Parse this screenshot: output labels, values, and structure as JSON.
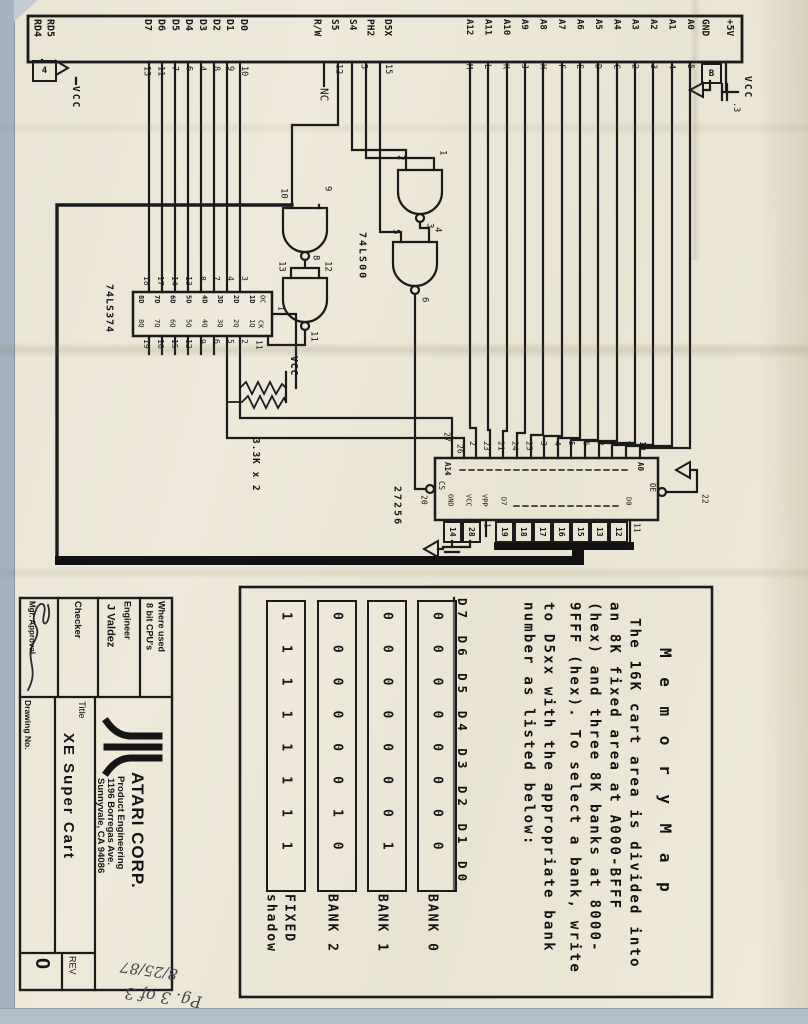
{
  "connector": {
    "left_labels": [
      "RD4",
      "RD5"
    ],
    "left_pin": "4",
    "left_vcc": "VCC",
    "data_labels": [
      "D7",
      "D6",
      "D5",
      "D4",
      "D3",
      "D2",
      "D1",
      "D0"
    ],
    "data_pins": [
      "13",
      "11",
      "7",
      "6",
      "4",
      "8",
      "9",
      "10"
    ],
    "ctrl_labels": [
      "R/W",
      "S5",
      "S4",
      "PH2",
      "D5X"
    ],
    "ctrl_pins": [
      "12",
      "5",
      "15"
    ],
    "nc": "NC",
    "addr_labels": [
      "A12",
      "A11",
      "A10",
      "A9",
      "A8",
      "A7",
      "A6",
      "A5",
      "A4",
      "A3",
      "A2",
      "A1",
      "A0"
    ],
    "addr_pins": [
      "M",
      "L",
      "K",
      "J",
      "H",
      "F",
      "E",
      "D",
      "C",
      "2",
      "3",
      "4",
      "5"
    ],
    "right_labels": [
      "GND",
      "+5V"
    ],
    "b_pin": "B",
    "cap_value": ".3",
    "right_vcc": "VCC"
  },
  "logic": {
    "chip": "74LS00",
    "gate_a": {
      "in1": "2",
      "in2": "1",
      "out": "3"
    },
    "gate_b": {
      "in1": "5",
      "in2": "4",
      "out": "6"
    },
    "gate_c": {
      "in1": "10",
      "in2": "9",
      "out": "8"
    },
    "gate_d": {
      "in1": "13",
      "in2": "12",
      "out": "11"
    }
  },
  "latch": {
    "chip": "74LS374",
    "top_pins": [
      "18",
      "17",
      "14",
      "13",
      "8",
      "7",
      "4",
      "3"
    ],
    "input_labels": [
      "8D",
      "7D",
      "6D",
      "5D",
      "4D",
      "3D",
      "2D",
      "1D"
    ],
    "output_labels": [
      "8Q",
      "7Q",
      "6Q",
      "5Q",
      "4Q",
      "3Q",
      "2Q",
      "1Q"
    ],
    "bottom_pins": [
      "19",
      "16",
      "15",
      "12",
      "9",
      "6",
      "5",
      "2"
    ],
    "oc_label": "OC",
    "oc_pin": "1",
    "clk_label": "CK",
    "clk_pin": "11"
  },
  "pullups": {
    "value": "3.3K x 2",
    "vcc": "VCC"
  },
  "eprom": {
    "chip": "27256",
    "pin_a14": "27",
    "pin_a13": "26",
    "addr_pins": [
      "2",
      "23",
      "21",
      "24",
      "25",
      "3",
      "4",
      "5",
      "6",
      "7",
      "8",
      "9",
      "10"
    ],
    "a14": "A14",
    "a0": "A0",
    "cs": "CS",
    "cs_pin": "20",
    "oe": "OE",
    "oe_pin": "22",
    "gnd": "GND",
    "vcc": "VCC",
    "vpp": "VPP",
    "d7": "D7",
    "d0": "D0",
    "power_pins": [
      "14",
      "28"
    ],
    "vpp_pin": "1",
    "data_pins": [
      "19",
      "18",
      "17",
      "16",
      "15",
      "13",
      "12"
    ],
    "d0_pin": "11"
  },
  "memory_map": {
    "title": "M e m o r y   M a p",
    "lines": [
      "The 16K cart area is divided into",
      "an 8K fixed area at A000-BFFF",
      "(hex) and three 8K banks at 8000-",
      "9FFF (hex). To select a bank, write",
      "to D5xx with  the appropriate bank",
      "number as listed below:"
    ],
    "table": {
      "header": "D7 D6 D5 D4 D3 D2 D1 D0",
      "rows": [
        {
          "bits": "00000000",
          "label": "BANK 0"
        },
        {
          "bits": "00000001",
          "label": "BANK 1"
        },
        {
          "bits": "00000010",
          "label": "BANK 2"
        },
        {
          "bits": "11111111",
          "label": "FIXED",
          "label2": "shadow"
        }
      ]
    }
  },
  "title_block": {
    "where_used_label": "Where used",
    "where_used": "8 bit CPU's",
    "engineer_label": "Engineer",
    "engineer": "J Valdez",
    "checker_label": "Checker",
    "mgr_label": "Mgr. Approval",
    "drawing_label": "Drawing No.",
    "company": "ATARI CORP.",
    "dept": "Product Engineering",
    "address1": "1196 Borregas Ave.",
    "address2": "Sunnyvale, CA 94086",
    "title_label": "Title",
    "title": "XE Super Cart",
    "rev_label": "REV",
    "rev": "0"
  },
  "notes": {
    "page": "Pg. 3 of 3",
    "date": "8/25/87"
  }
}
